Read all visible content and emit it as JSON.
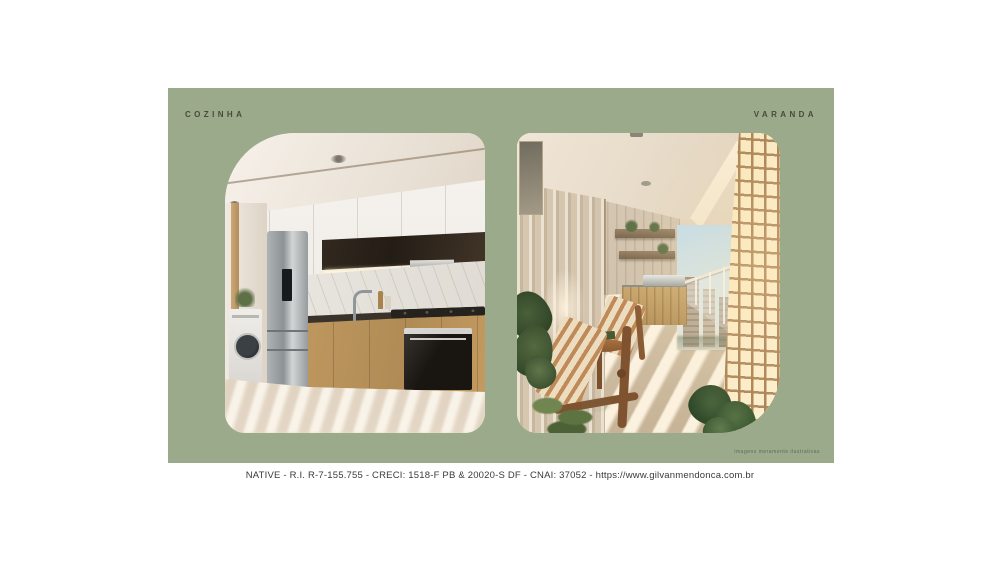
{
  "slide": {
    "panel_color": "#9aaa8a",
    "label_color": "#494a3c",
    "sections": [
      {
        "id": "kitchen",
        "label": "COZINHA"
      },
      {
        "id": "balcony",
        "label": "VARANDA"
      }
    ],
    "watermark": "imagens meramente ilustrativas"
  },
  "footer": {
    "text": "NATIVE - R.I. R-7-155.755 - CRECI: 1518-F PB & 20020-S DF - CNAI: 37052 - https://www.gilvanmendonca.com.br",
    "text_color": "#3a3a3a"
  }
}
